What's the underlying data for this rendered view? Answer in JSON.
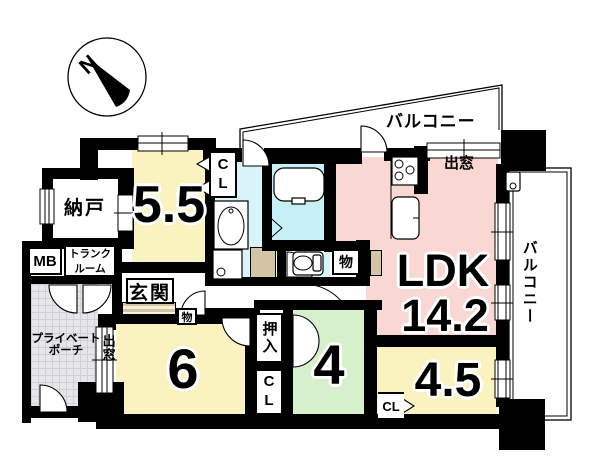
{
  "compass": {
    "north_label": "N"
  },
  "labels": {
    "balcony_top": "バルコニー",
    "balcony_right": "バルコニー",
    "bay_window_top": "出窓",
    "bay_window_left": "出窓",
    "nando": "納戸",
    "mb": "MB",
    "trunk_line1": "トランク",
    "trunk_line2": "ルーム",
    "genkan": "玄関",
    "porch_line1": "プライベート",
    "porch_line2": "ポーチ",
    "mono_hall": "物",
    "mono_ldk": "物",
    "oshiire": "押入",
    "cl_55": "CL",
    "cl_6": "CL",
    "cl_45": "CL"
  },
  "rooms": {
    "ldk": {
      "name": "LDK",
      "size": "14.2"
    },
    "bedroom_55": {
      "size": "5.5"
    },
    "bedroom_6": {
      "size": "6"
    },
    "bedroom_4": {
      "size": "4"
    },
    "bedroom_45": {
      "size": "4.5"
    }
  },
  "colors": {
    "room_yellow": "#faf3c0",
    "room_pink": "#f9d8d3",
    "room_green": "#d6f0cc",
    "bath_cyan": "#c6f0f5",
    "tub_cyan": "#7ce6ef",
    "washroom_cyan": "#d9f4f8",
    "porch_gray": "#e6e6ea",
    "tile_tan": "#d3c4a5",
    "wall_black": "#000000"
  }
}
